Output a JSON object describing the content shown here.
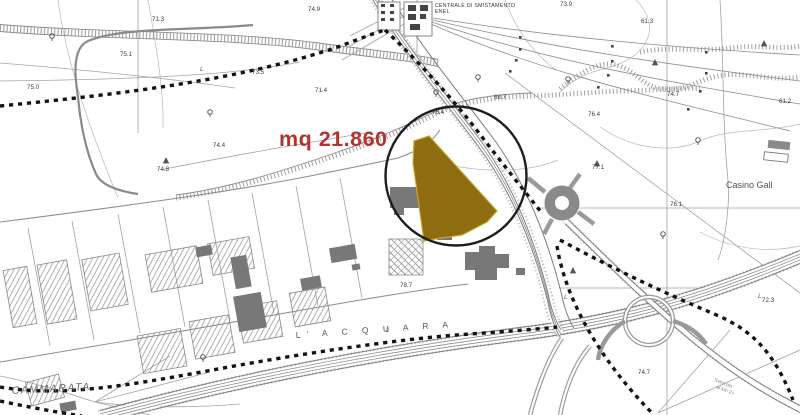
{
  "annotation": {
    "area": "mq 21.860"
  },
  "colors": {
    "annotation": "#b23431",
    "parcel": "#8e6c10",
    "parcel_edge": "#caa62c",
    "boundary": "#141414",
    "circle": "#1e1e1e"
  },
  "labels": {
    "centrale1": "CENTRALE DI SMISTAMENTO",
    "centrale2": "ENEL",
    "casino": "Casino Gall",
    "cammarata": "CAMMARATA",
    "acquara": "L' A C Q U A R A",
    "svincolo1": "Svincolo",
    "svincolo2": "al km 2+"
  },
  "elevations": [
    "75.1",
    "71.3",
    "75.0",
    "74.9",
    "73.5",
    "71.4",
    "74.4",
    "74.8",
    "73.9",
    "61.3",
    "74.7",
    "61.2",
    "76.4",
    "76.4",
    "68.7",
    "77.1",
    "78.7",
    "72.3",
    "76.1",
    "74.7"
  ],
  "letters": [
    "L",
    "L",
    "L",
    "L"
  ]
}
